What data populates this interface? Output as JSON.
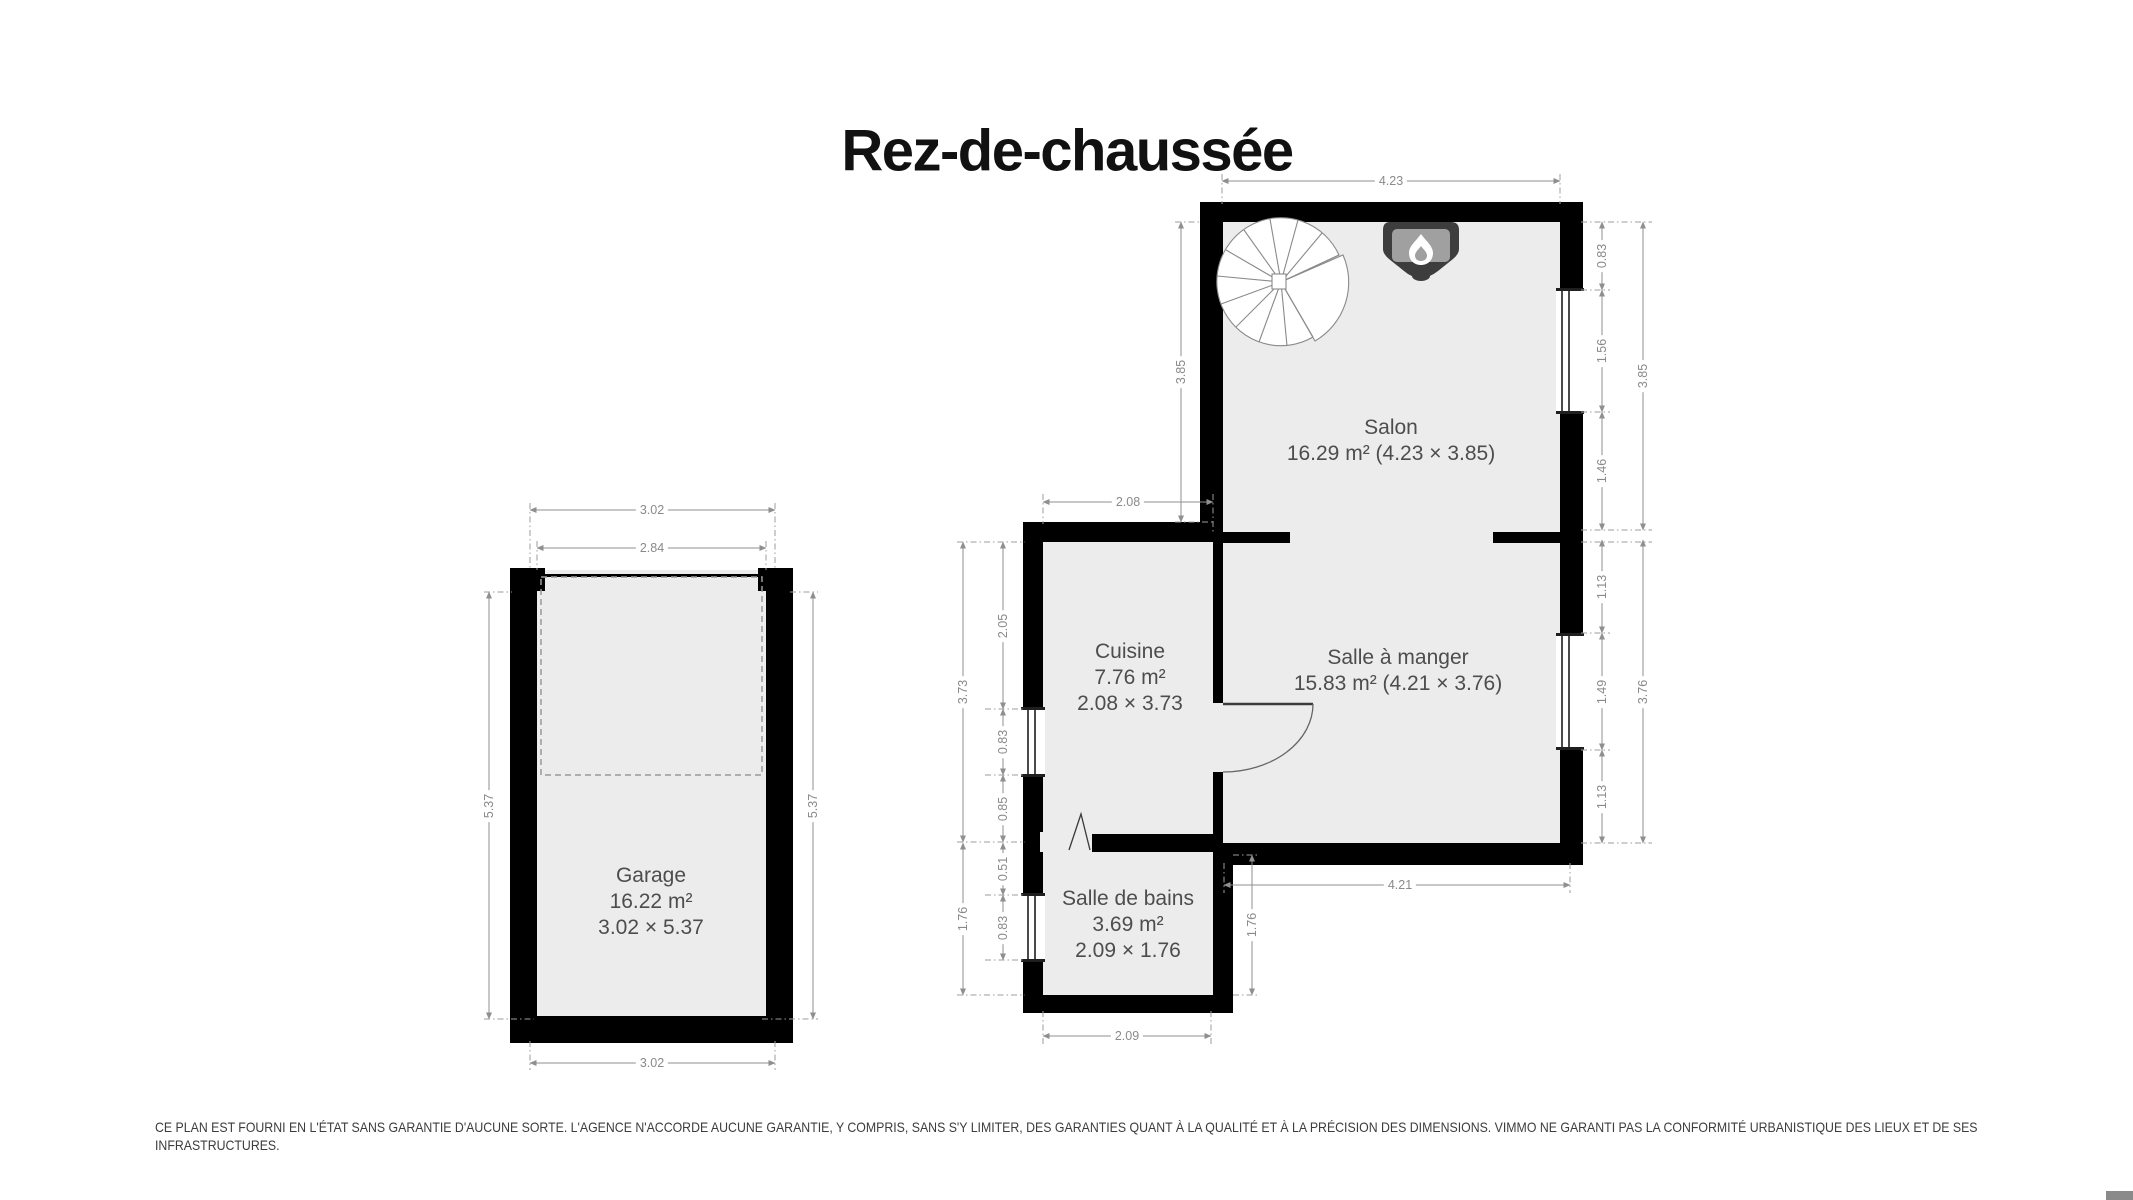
{
  "title": "Rez-de-chaussée",
  "rooms": {
    "garage": {
      "name": "Garage",
      "area": "16.22 m²",
      "dims": "3.02 × 5.37"
    },
    "salon": {
      "name": "Salon",
      "area_dims": "16.29 m² (4.23 × 3.85)"
    },
    "cuisine": {
      "name": "Cuisine",
      "area": "7.76 m²",
      "dims": "2.08 × 3.73"
    },
    "salle_a_manger": {
      "name": "Salle à manger",
      "area_dims": "15.83 m² (4.21 × 3.76)"
    },
    "salle_de_bains": {
      "name": "Salle de bains",
      "area": "3.69 m²",
      "dims": "2.09 × 1.76"
    }
  },
  "dimensions": {
    "garage": {
      "top_outer": "3.02",
      "top_inner": "2.84",
      "left": "5.37",
      "right": "5.37",
      "bottom": "3.02"
    },
    "salon": {
      "top": "4.23",
      "left": "3.85",
      "right_segments": [
        "0.83",
        "1.56",
        "1.46"
      ],
      "right_total": "3.85"
    },
    "cuisine": {
      "top": "2.08",
      "left_segments": [
        "2.05",
        "0.83",
        "0.85"
      ],
      "left_total": "3.73"
    },
    "salle_a_manger": {
      "bottom": "4.21",
      "right_segments": [
        "1.13",
        "1.49",
        "1.13"
      ],
      "right_total": "3.76"
    },
    "salle_de_bains": {
      "left_segments": [
        "0.51",
        "0.83"
      ],
      "left_total": "1.76",
      "bottom": "2.09",
      "right": "1.76"
    }
  },
  "disclaimer": {
    "line1": "CE PLAN EST FOURNI EN L'ÉTAT SANS GARANTIE D'AUCUNE SORTE. L'AGENCE N'ACCORDE AUCUNE GARANTIE, Y COMPRIS, SANS S'Y LIMITER, DES GARANTIES QUANT À LA QUALITÉ ET À LA PRÉCISION DES DIMENSIONS. VIMMO NE GARANTI PAS LA CONFORMITÉ URBANISTIQUE DES LIEUX ET DE SES",
    "line2": "INFRASTRUCTURES."
  },
  "icons": {
    "fireplace": "flame-icon",
    "staircase": "spiral-staircase-icon"
  },
  "colors": {
    "wall": "#000000",
    "floor": "#ececec",
    "dimension_gray": "#8f8f8f",
    "room_label_gray": "#4d4d4d",
    "fireplace_dark": "#3d3d3d",
    "fireplace_light": "#a0a0a0",
    "title_black": "#111111",
    "corner_chip_gray": "#8a8a8a"
  }
}
